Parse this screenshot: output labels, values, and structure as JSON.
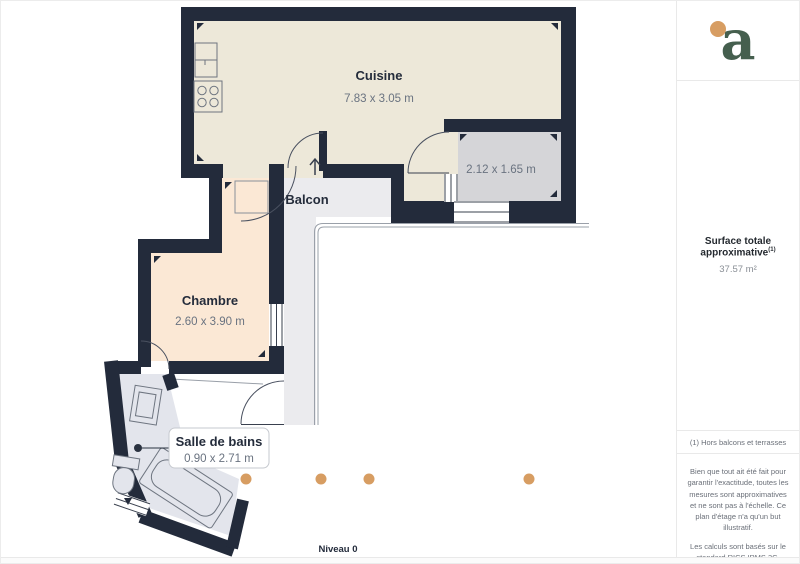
{
  "plan": {
    "level_label": "Niveau 0",
    "rooms": {
      "cuisine": {
        "name": "Cuisine",
        "dims": "7.83 x 3.05 m"
      },
      "balcon": {
        "name": "Balcon"
      },
      "chambre": {
        "name": "Chambre",
        "dims": "2.60 x 3.90 m"
      },
      "salle_de_bains": {
        "name": "Salle de bains",
        "dims": "0.90 x 2.71 m"
      },
      "terrasse_grise": {
        "dims": "2.12 x 1.65 m"
      }
    },
    "colors": {
      "wall": "#232b3b",
      "kitchen": "#ede8d9",
      "bedroom": "#fbe8d5",
      "bathroom": "#e3e5ec",
      "balcony_floor": "#ebebee",
      "terrace_room": "#d5d5d8",
      "camera_dot": "#d79d62",
      "logo_green": "#455f4e",
      "logo_orange": "#d79d62"
    }
  },
  "sidebar": {
    "logo_letter": "a",
    "surface_title": "Surface totale approximative",
    "surface_sup": "(1)",
    "surface_value": "37.57 m²",
    "footnote": "(1) Hors balcons et terrasses",
    "disclaimer_1": "Bien que tout ait été fait pour garantir l'exactitude, toutes les mesures sont approximatives et ne sont pas à l'échelle. Ce plan d'étage n'a qu'un but illustratif.",
    "disclaimer_2": "Les calculs sont basés sur le standard RICS IPMS 3C.",
    "brand_name": "GIRAFFE",
    "brand_suffix": "360"
  }
}
